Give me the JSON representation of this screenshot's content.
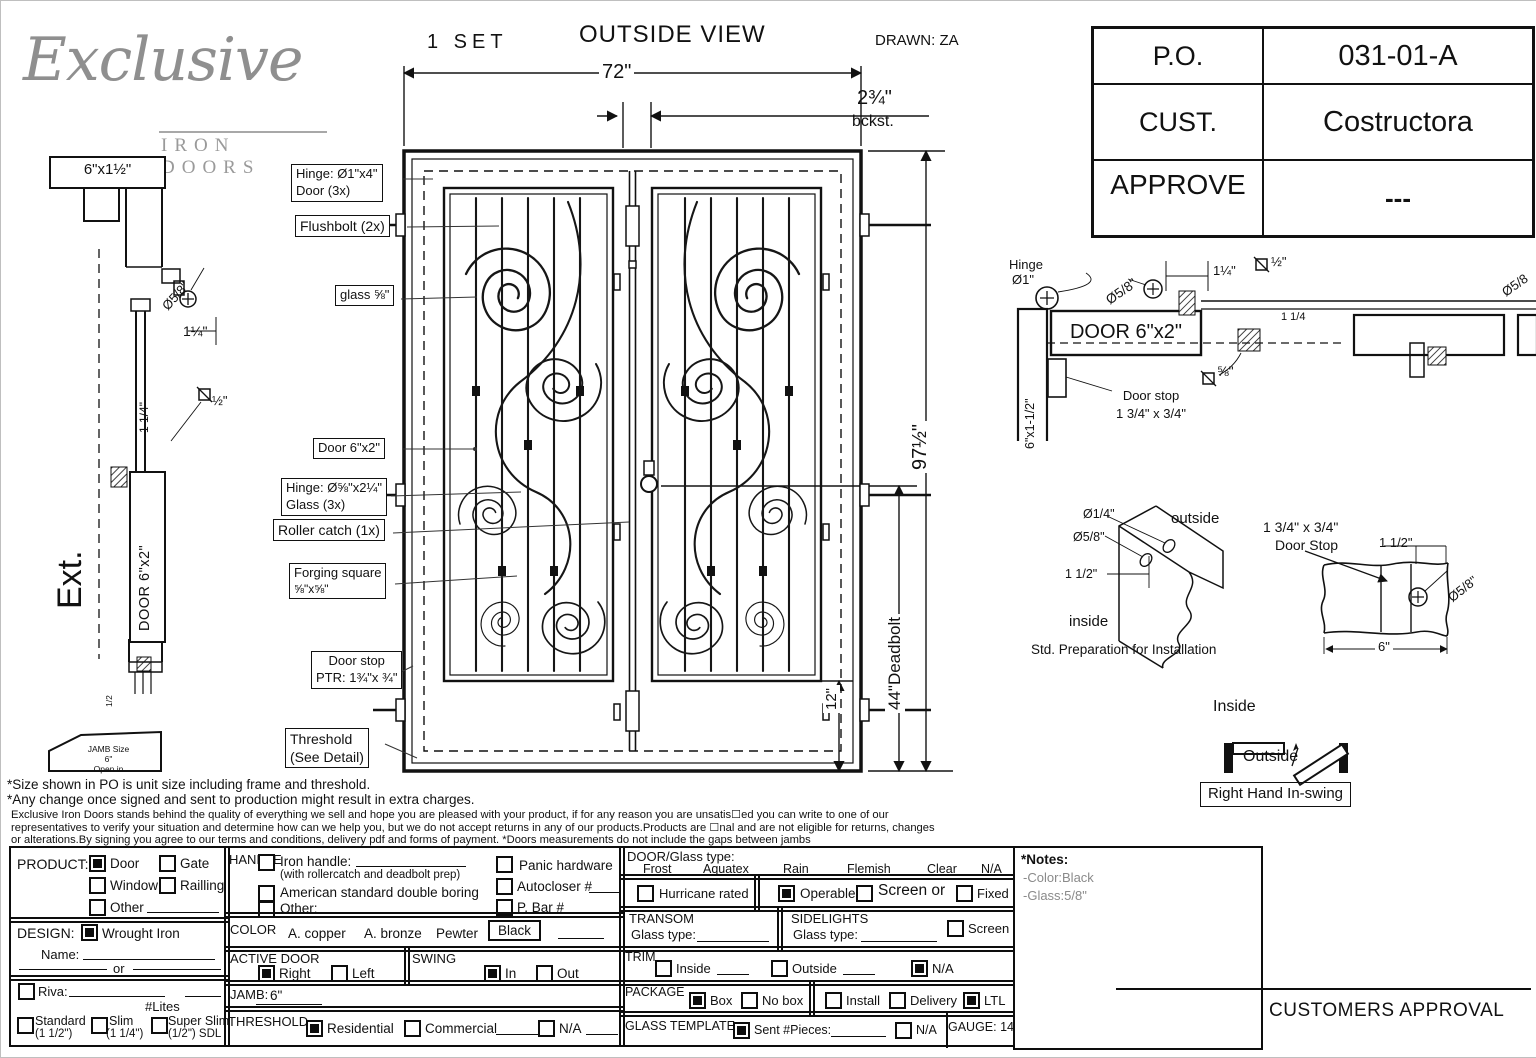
{
  "header": {
    "set": "1 SET",
    "title": "OUTSIDE VIEW",
    "drawn": "DRAWN: ZA"
  },
  "logo": {
    "brand": "Exclusive",
    "sub": "IRON DOORS"
  },
  "title_block": {
    "po_label": "P.O.",
    "po_value": "031-01-A",
    "cust_label": "CUST.",
    "cust_value": "Costructora",
    "approve_label": "APPROVE",
    "approve_value": "---"
  },
  "view": {
    "dim_width": "72\"",
    "backset": "2¾\"",
    "backset_sub": "bckst.",
    "dim_height": "97½\"",
    "dim_deadbolt": "44\"Deadbolt",
    "dim_bottom": "12\"",
    "callout_hinge_door_1": "Hinge: Ø1\"x4\"",
    "callout_hinge_door_2": "Door (3x)",
    "callout_flushbolt": "Flushbolt (2x)",
    "callout_glass": "glass ⅝\"",
    "callout_door": "Door  6\"x2\"",
    "callout_hinge_glass_1": "Hinge: Ø⅝\"x2¼\"",
    "callout_hinge_glass_2": "Glass (3x)",
    "callout_roller": "Roller catch  (1x)",
    "callout_forging_1": "Forging square",
    "callout_forging_2": "⅝\"x⅝\"",
    "callout_doorstop_1": "Door stop",
    "callout_doorstop_2": "PTR: 1¾\"x ¾\"",
    "callout_threshold_1": "Threshold",
    "callout_threshold_2": "(See Detail)"
  },
  "left_detail": {
    "head": "6\"x1½\"",
    "dia": "Ø5/8\"",
    "quarter": "1¼\"",
    "quarter_v": "1 1/4\"",
    "half_sq": "½\"",
    "door": "DOOR 6\"x2\"",
    "ext": "Ext.",
    "half_small": "1/2",
    "jamb1": "JAMB Size",
    "jamb2": "6\"",
    "jamb3": "Open in"
  },
  "right_detail": {
    "hinge1": "Hinge",
    "hinge2": "Ø1\"",
    "door": "DOOR 6\"x2\"",
    "jamb": "6\"x1-1/2\"",
    "dia": "Ø5/8\"",
    "quarter": "1¼\"",
    "half_sq": "½\"",
    "dia_edge": "Ø5/8",
    "quarter_b": "1 1/4",
    "eighth_sq": "⅝\"",
    "stop1": "Door stop",
    "stop2": "1 3/4\" x 3/4\""
  },
  "prep": {
    "d14": "Ø1/4\"",
    "d58": "Ø5/8\"",
    "d112": "1 1/2\"",
    "outside": "outside",
    "inside": "inside",
    "caption": "Std. Preparation for Installation"
  },
  "stop": {
    "l1": "1 3/4\" x 3/4\"",
    "l2": "Door Stop",
    "d112": "1 1/2\"",
    "d58": "Ø5/8\"",
    "d6": "6\""
  },
  "swing_d": {
    "inside": "Inside",
    "outside": "Outside",
    "caption": "Right Hand In-swing"
  },
  "notes": {
    "line1": "*Size shown in PO is unit size including frame and threshold.",
    "line2": "*Any change once signed and sent to production might result in extra charges.",
    "para1": "Exclusive Iron Doors stands behind the quality of everything we sell and hope you are pleased with your product, if for any reason you are unsatis☐ed you can write to one of our",
    "para2": "representatives to verify your situation and determine how can we help you, but we do not accept returns in any of our products.Products are ☐nal and are not eligible for returns, changes",
    "para3": "or alterations.By signing you agree to our terms and conditions, delivery pdf and forms of payment. *Doors measurements do not include the gaps between jambs"
  },
  "form": {
    "product": {
      "label": "PRODUCT:",
      "door": {
        "label": "Door",
        "checked": true
      },
      "gate": {
        "label": "Gate",
        "checked": false
      },
      "window": {
        "label": "Window",
        "checked": false
      },
      "railling": {
        "label": "Railling",
        "checked": false
      },
      "other": {
        "label": "Other",
        "checked": false
      }
    },
    "design": {
      "label": "DESIGN:",
      "wrought": {
        "label": "Wrought Iron",
        "checked": true
      },
      "name_label": "Name:",
      "or_label": "or",
      "riva": {
        "label": "Riva:",
        "checked": false
      },
      "lites": "#Lites",
      "standard": {
        "label": "Standard",
        "sub": "(1 1/2\")",
        "checked": false
      },
      "slim": {
        "label": "Slim",
        "sub": "(1 1/4\")",
        "checked": false
      },
      "superslim": {
        "label": "Super Slim",
        "sub": "(1/2\") SDL",
        "checked": false
      }
    },
    "handle": {
      "label": "HANDLE",
      "iron": {
        "label": "Iron handle:",
        "sub": "(with rollercatch and deadbolt prep)",
        "checked": false
      },
      "american": {
        "label": "American standard double boring",
        "checked": false
      },
      "other": {
        "label": "Other:",
        "checked": false
      },
      "panic": {
        "label": "Panic hardware",
        "checked": false
      },
      "autocloser": {
        "label": "Autocloser #",
        "checked": false
      },
      "pbar": {
        "label": "P. Bar #",
        "checked": false
      }
    },
    "color": {
      "label": "COLOR",
      "copper": "A. copper",
      "bronze": "A. bronze",
      "pewter": "Pewter",
      "black": "Black"
    },
    "active_door": {
      "label": "ACTIVE DOOR",
      "right": {
        "label": "Right",
        "checked": true
      },
      "left": {
        "label": "Left",
        "checked": false
      }
    },
    "swing": {
      "label": "SWING",
      "in_opt": {
        "label": "In",
        "checked": true
      },
      "out_opt": {
        "label": "Out",
        "checked": false
      }
    },
    "jamb": {
      "label": "JAMB:",
      "value": "6\""
    },
    "threshold": {
      "label": "THRESHOLD",
      "residential": {
        "label": "Residential",
        "checked": true
      },
      "commercial": {
        "label": "Commercial",
        "checked": false
      },
      "na": {
        "label": "N/A",
        "checked": false
      }
    },
    "door_glass": {
      "label": "DOOR/Glass type:",
      "options": [
        "Frost",
        "Aquatex",
        "Rain",
        "Flemish",
        "Clear",
        "N/A"
      ]
    },
    "hurricane": {
      "label": "Hurricane rated",
      "checked": false
    },
    "operable": {
      "label": "Operable",
      "checked": true
    },
    "screen_or": {
      "label": "Screen or",
      "checked": false
    },
    "fixed": {
      "label": "Fixed",
      "checked": false
    },
    "transom": {
      "label": "TRANSOM",
      "glass_label": "Glass type:"
    },
    "sidelights": {
      "label": "SIDELIGHTS",
      "glass_label": "Glass type:",
      "screen": {
        "label": "Screen",
        "checked": false
      }
    },
    "trim": {
      "label": "TRIM",
      "inside": {
        "label": "Inside",
        "checked": false
      },
      "outside": {
        "label": "Outside",
        "checked": false
      },
      "na": {
        "label": "N/A",
        "checked": true
      }
    },
    "package": {
      "label": "PACKAGE",
      "box": {
        "label": "Box",
        "checked": true
      },
      "nobox": {
        "label": "No box",
        "checked": false
      },
      "install": {
        "label": "Install",
        "checked": false
      },
      "delivery": {
        "label": "Delivery",
        "checked": false
      },
      "ltl": {
        "label": "LTL",
        "checked": true
      }
    },
    "glass_template": {
      "label": "GLASS TEMPLATE",
      "sent": {
        "label": "Sent #Pieces:",
        "checked": true
      },
      "na": {
        "label": "N/A",
        "checked": false
      }
    },
    "gauge": "GAUGE: 14",
    "notes_box": {
      "title": "*Notes:",
      "c": "-Color:Black",
      "g": "-Glass:5/8\""
    },
    "approval": "CUSTOMERS APPROVAL"
  }
}
